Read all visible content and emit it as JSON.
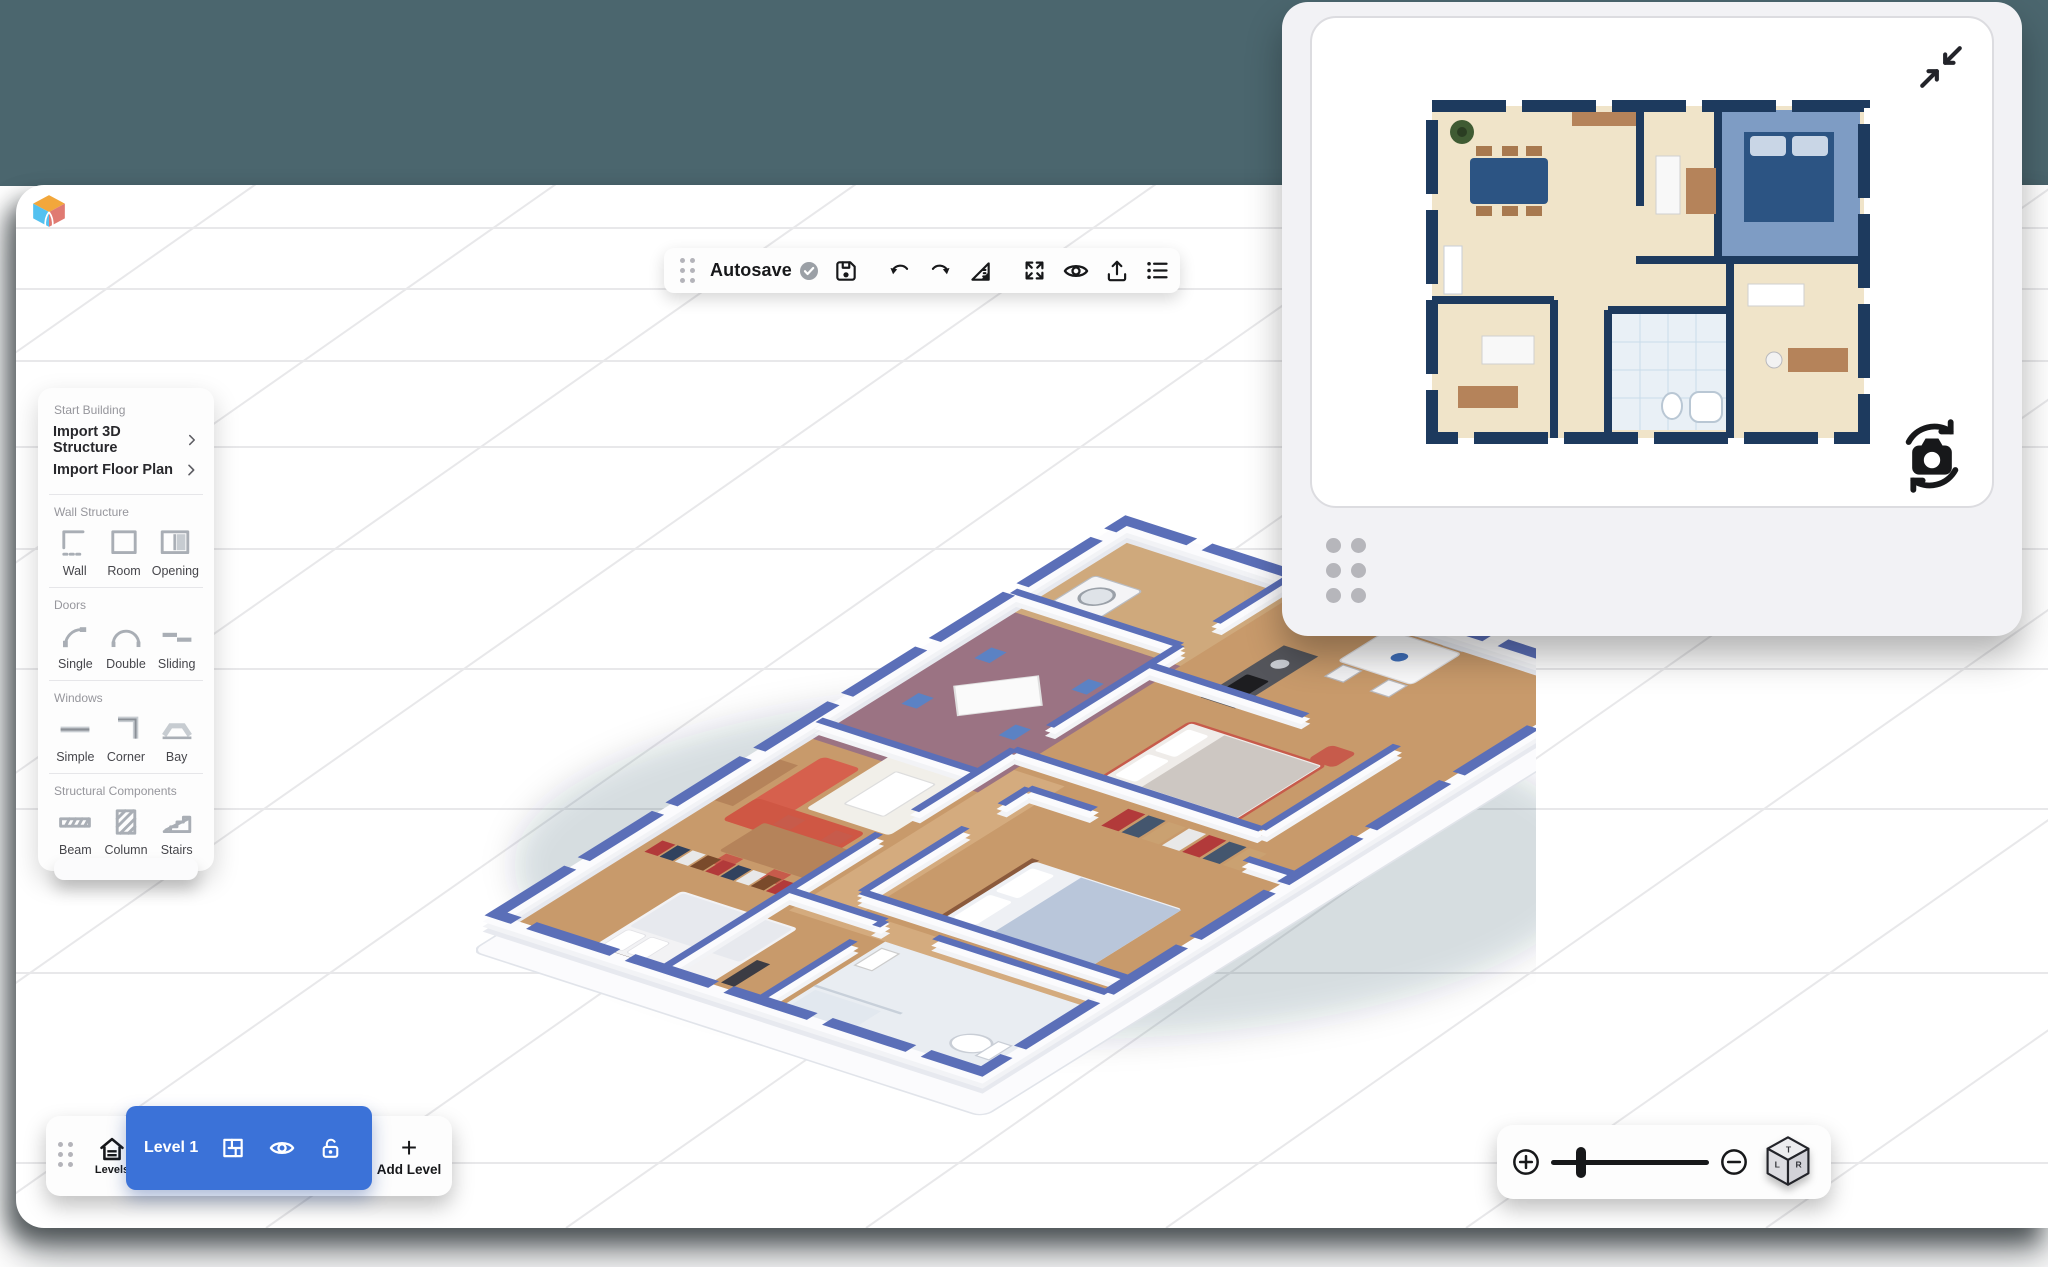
{
  "toolbar": {
    "autosave_label": "Autosave",
    "icons": [
      "drag-handle",
      "saved-check",
      "save",
      "undo",
      "redo",
      "measure",
      "fit-view",
      "visibility",
      "export",
      "list"
    ]
  },
  "left_panel": {
    "sections": [
      {
        "label": "Start Building",
        "rows": [
          {
            "label": "Import 3D Structure"
          },
          {
            "label": "Import Floor Plan"
          }
        ]
      },
      {
        "label": "Wall Structure",
        "items": [
          {
            "label": "Wall",
            "icon": "wall-icon"
          },
          {
            "label": "Room",
            "icon": "room-icon"
          },
          {
            "label": "Opening",
            "icon": "opening-icon"
          }
        ]
      },
      {
        "label": "Doors",
        "items": [
          {
            "label": "Single",
            "icon": "single-door-icon"
          },
          {
            "label": "Double",
            "icon": "double-door-icon"
          },
          {
            "label": "Sliding",
            "icon": "sliding-door-icon"
          }
        ]
      },
      {
        "label": "Windows",
        "items": [
          {
            "label": "Simple",
            "icon": "simple-window-icon"
          },
          {
            "label": "Corner",
            "icon": "corner-window-icon"
          },
          {
            "label": "Bay",
            "icon": "bay-window-icon"
          }
        ]
      },
      {
        "label": "Structural Components",
        "items": [
          {
            "label": "Beam",
            "icon": "beam-icon"
          },
          {
            "label": "Column",
            "icon": "column-icon"
          },
          {
            "label": "Stairs",
            "icon": "stairs-icon"
          }
        ]
      }
    ]
  },
  "levels_bar": {
    "levels_label": "Levels",
    "active_level_label": "Level 1",
    "add_level_label": "Add Level"
  },
  "zoom_bar": {
    "cube": {
      "top": "T",
      "left": "L",
      "right": "R"
    }
  },
  "minimap_panel": {
    "icons": [
      "collapse-icon",
      "rotate-camera-icon",
      "drag-handle"
    ]
  },
  "colors": {
    "accent_blue": "#3b72d8",
    "backdrop_teal": "#4b666e",
    "plan_wall_navy": "#1d3a5e",
    "wall_top_blue": "#5b6fb8",
    "wood_floor": "#c89a6b",
    "purple_floor": "#9b7383",
    "sofa_red": "#d6604d"
  }
}
